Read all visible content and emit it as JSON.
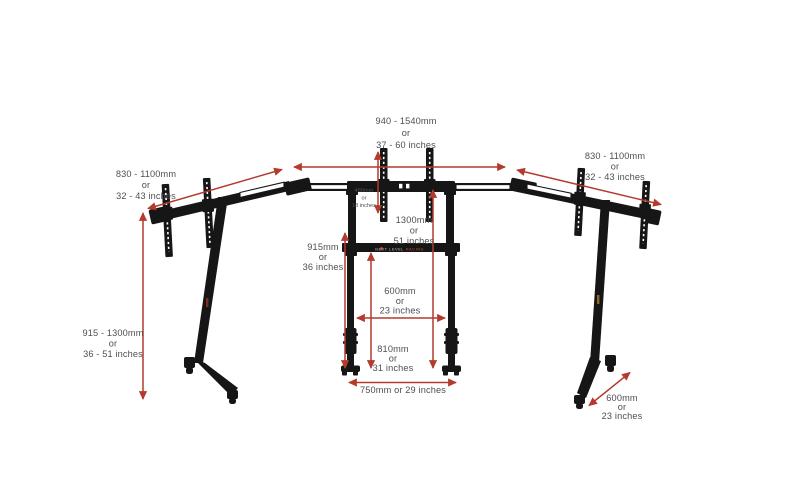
{
  "diagram": {
    "subject": "triple-monitor-stand-dimension-diagram",
    "background": "#ffffff",
    "colors": {
      "arrow_red": "#b43a2e",
      "structure_black": "#161616",
      "label_gray": "#4f4f4f",
      "brand_red": "#e05039",
      "brand_gray": "#cfcfcf"
    },
    "brand": {
      "part1": "NEXT LEVEL",
      "part2": "RACING"
    },
    "dimensions": {
      "overall_width_center": {
        "lines": [
          "940 - 1540mm",
          "or",
          "37 - 60 inches"
        ]
      },
      "left_wing_width": {
        "lines": [
          "830 - 1100mm",
          "or",
          "32 - 43 inches"
        ]
      },
      "right_wing_width": {
        "lines": [
          "830 - 1100mm",
          "or",
          "32 - 43 inches"
        ]
      },
      "side_height_range": {
        "lines": [
          "915 - 1300mm",
          "or",
          "36 - 51 inches"
        ]
      },
      "vesa_rail_height": {
        "lines": [
          "480mm",
          "or",
          "18 inches"
        ]
      },
      "center_total_height": {
        "lines": [
          "1300mm",
          "or",
          "51 inches"
        ]
      },
      "center_frame_height": {
        "lines": [
          "915mm",
          "or",
          "36 inches"
        ]
      },
      "leg_inner_width": {
        "lines": [
          "600mm",
          "or",
          "23 inches"
        ]
      },
      "lower_section_height": {
        "lines": [
          "810mm",
          "or",
          "31 inches"
        ]
      },
      "base_width": {
        "lines": [
          "750mm or 29 inches"
        ]
      },
      "foot_depth": {
        "lines": [
          "600mm",
          "or",
          "23 inches"
        ]
      }
    }
  }
}
